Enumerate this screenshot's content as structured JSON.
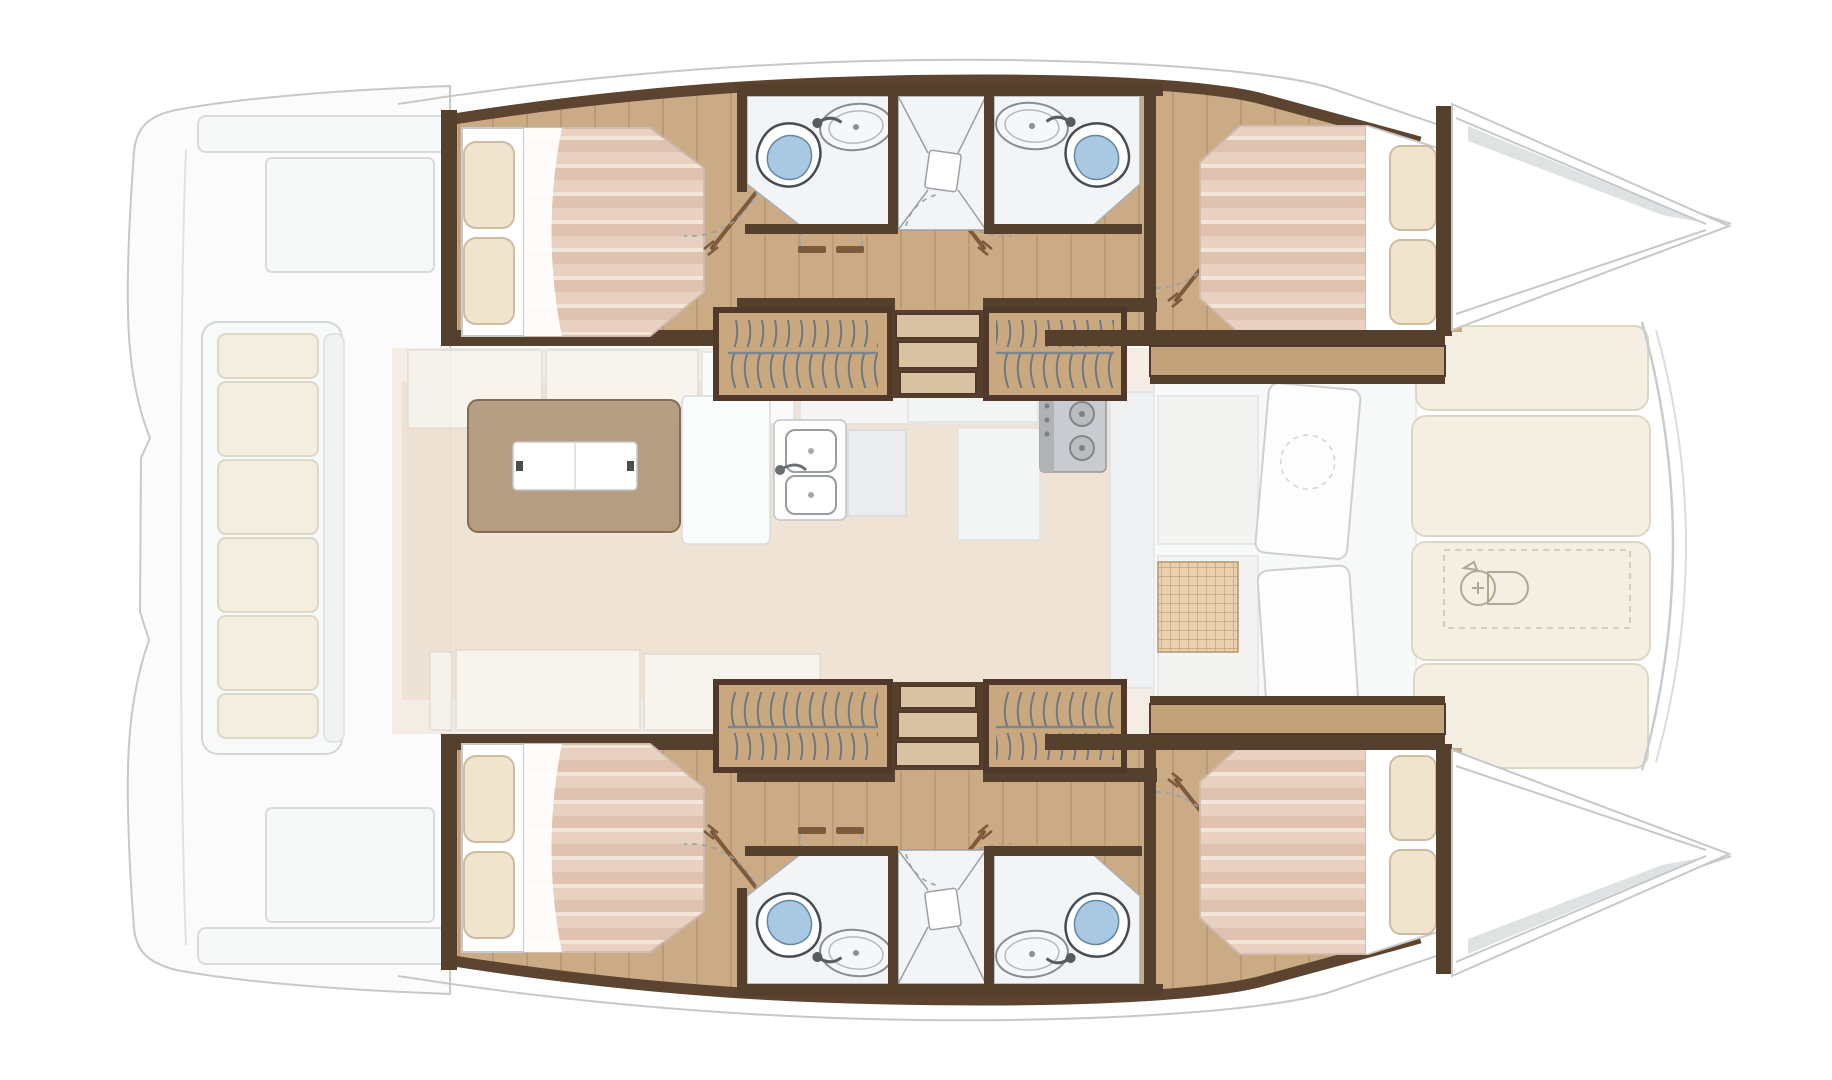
{
  "canvas": {
    "width": 1832,
    "height": 1080
  },
  "figure": {
    "type": "boat-floor-plan",
    "subject": "catamaran interior layout, top-down view",
    "orientation": "bow-right-stern-left"
  },
  "colors": {
    "background": "#ffffff",
    "outline_gray": "#c6c9cc",
    "deck_fill": "#fbfbfc",
    "wood_floor": "#cbaa86",
    "dark_wood": "#54402c",
    "trim_wood": "#5d4430",
    "door_wood": "#7c5a3b",
    "wardrobe_wood": "#c9a87f",
    "steps_wood": "#d8c2a2",
    "shelf_tan": "#c2a379",
    "bed_sheet": "#ffffff",
    "blanket": "#e8d1c1",
    "blanket_stripe": "#e0c2b0",
    "pillow": "#f0e4cf",
    "bath_floor": "#f2f4f5",
    "fixture_outline": "#464c52",
    "toilet_blue": "#a9c9e2",
    "steel_gray": "#c3c7cb",
    "table_wood": "#a98d6d",
    "table_leaf": "#ffffff",
    "saloon_floor": "#f3ece3",
    "saloon_wood": "#ead8c3",
    "cushion_cream": "#f3eee0",
    "sunpad_cream": "#f4efe2",
    "mat_tan": "#e8cda9",
    "mat_line": "#c49c6d"
  },
  "elements": {
    "hulls": [
      {
        "name": "starboard-hull",
        "position": "top",
        "features": [
          "aft-double-bed",
          "cabin-door",
          "bathroom-toilet-sink",
          "shared-shower",
          "bathroom-sink-toilet",
          "wardrobe-aft",
          "companionway-steps",
          "wardrobe-fwd",
          "forward-double-bed",
          "bow-deck"
        ]
      },
      {
        "name": "port-hull",
        "position": "bottom",
        "features": [
          "aft-double-bed",
          "cabin-door",
          "bathroom-toilet-sink",
          "shared-shower",
          "bathroom-sink-toilet",
          "wardrobe-aft",
          "companionway-steps",
          "wardrobe-fwd",
          "forward-double-bed",
          "bow-deck"
        ]
      }
    ],
    "center_deck": {
      "saloon": [
        "settee-cushions",
        "folding-table",
        "galley-counter",
        "double-sink",
        "appliance",
        "stove-two-burners",
        "cabinets"
      ],
      "forward_cockpit": [
        "bench-seats",
        "door-panels",
        "woven-mat"
      ],
      "foredeck": [
        "sunpad-panels",
        "anchor-windlass-hatch"
      ],
      "aft_deck": [
        "transverse-bench-with-cushions",
        "lockers",
        "aft-beam-platforms"
      ]
    }
  },
  "counts": {
    "double_beds": 4,
    "toilets": 4,
    "bathroom_sinks": 4,
    "showers": 2,
    "wardrobes": 4,
    "companionway_steps": 2,
    "sunpad_panels": 4,
    "aft_bench_cushions": 6
  }
}
